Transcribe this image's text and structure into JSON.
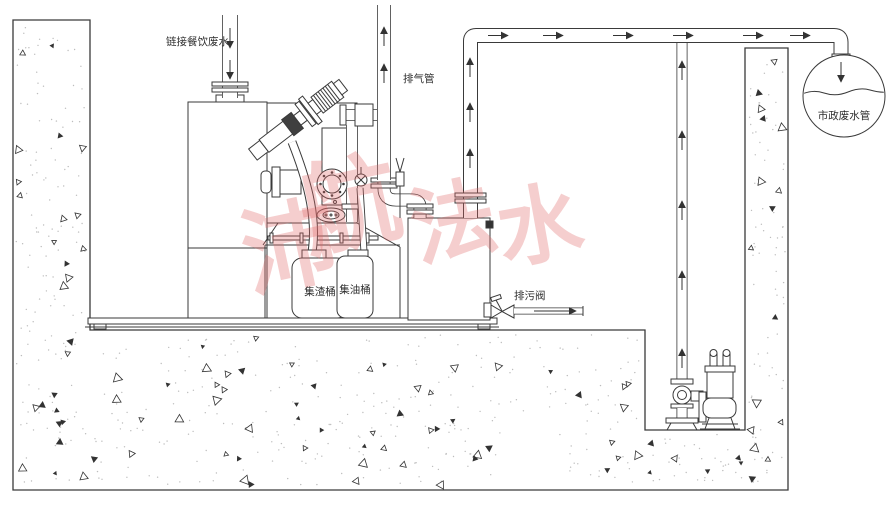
{
  "diagram": {
    "title": "grease-separator-lifting-system-diagram",
    "labels": {
      "inlet": "链接餐饮废水",
      "vent": "排气管",
      "municipal": "市政废水管",
      "slag_bucket": "集渣桶",
      "oil_bucket": "集油桶",
      "drain_valve": "排污阀"
    },
    "watermark": {
      "text": "沛航法水",
      "chars": [
        "沛",
        "航",
        "法",
        "水"
      ],
      "color": "#e06666"
    },
    "colors": {
      "line": "#3a3a3a",
      "background": "#ffffff",
      "hatch": "#333333",
      "watermark": "#e06666"
    }
  }
}
